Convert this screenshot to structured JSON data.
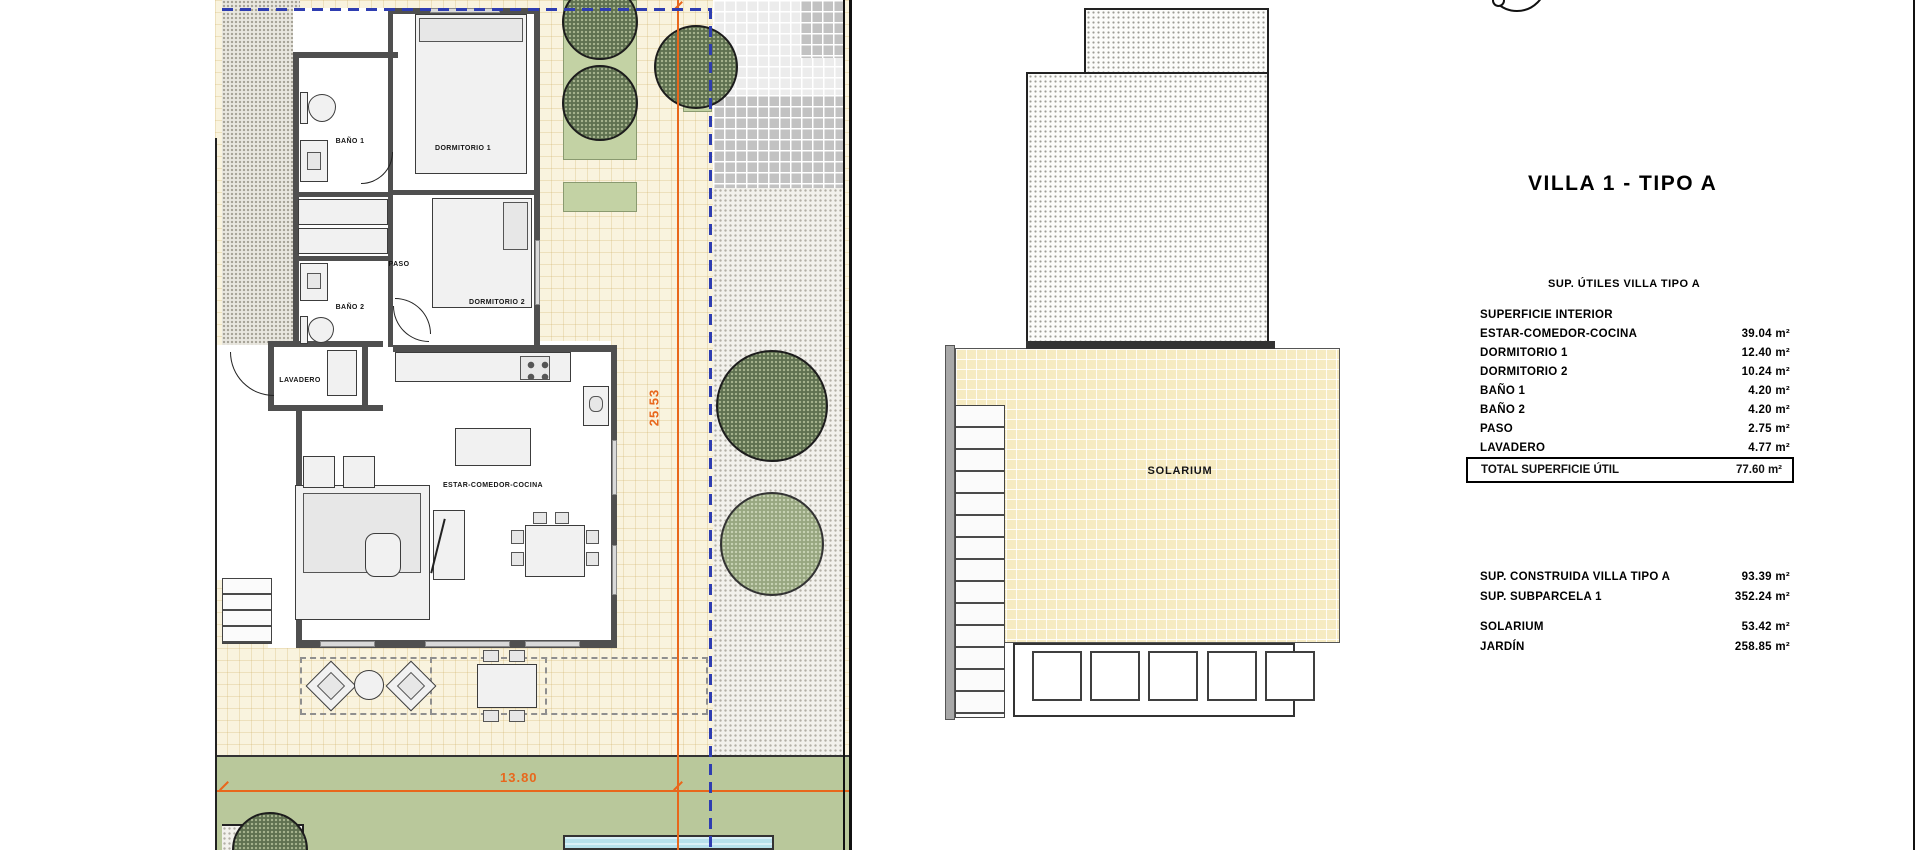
{
  "title": "VILLA 1 - TIPO A",
  "areas": {
    "heading": "SUP. ÚTILES VILLA TIPO A",
    "section": "SUPERFICIE INTERIOR",
    "rows": [
      {
        "label": "ESTAR-COMEDOR-COCINA",
        "value": "39.04 m²"
      },
      {
        "label": "DORMITORIO 1",
        "value": "12.40 m²"
      },
      {
        "label": "DORMITORIO 2",
        "value": "10.24 m²"
      },
      {
        "label": "BAÑO 1",
        "value": "4.20 m²"
      },
      {
        "label": "BAÑO 2",
        "value": "4.20 m²"
      },
      {
        "label": "PASO",
        "value": "2.75 m²"
      },
      {
        "label": "LAVADERO",
        "value": "4.77 m²"
      }
    ],
    "total": {
      "label": "TOTAL SUPERFICIE ÚTIL",
      "value": "77.60 m²"
    }
  },
  "summary": {
    "rows": [
      {
        "label": "SUP. CONSTRUIDA VILLA TIPO A",
        "value": "93.39 m²"
      },
      {
        "label": "SUP. SUBPARCELA 1",
        "value": "352.24 m²"
      },
      {
        "label": "SOLARIUM",
        "value": "53.42 m²"
      },
      {
        "label": "JARDÍN",
        "value": "258.85 m²"
      }
    ]
  },
  "floorplan": {
    "labels": {
      "bano1": "BAÑO 1",
      "dorm1": "DORMITORIO 1",
      "paso": "PASO",
      "bano2": "BAÑO 2",
      "dorm2": "DORMITORIO 2",
      "lavadero": "LAVADERO",
      "estar": "ESTAR-COMEDOR-COCINA"
    },
    "dimensions": {
      "width": "13.80",
      "depth": "25.53"
    }
  },
  "solarium": {
    "label": "SOLARIUM"
  },
  "colors": {
    "dimension_orange": "#e8671c",
    "parcel_dashed_blue": "#2e3db1",
    "wall_gray": "#4f4f4f",
    "paving_cream": "#f9f3de",
    "solarium_yellow": "#f6ebc2",
    "lawn_green": "#b9c89b",
    "tree_dark_green": "#5f7150",
    "tree_light_green": "#97a680",
    "pool_blue": "#b7e1ec"
  }
}
